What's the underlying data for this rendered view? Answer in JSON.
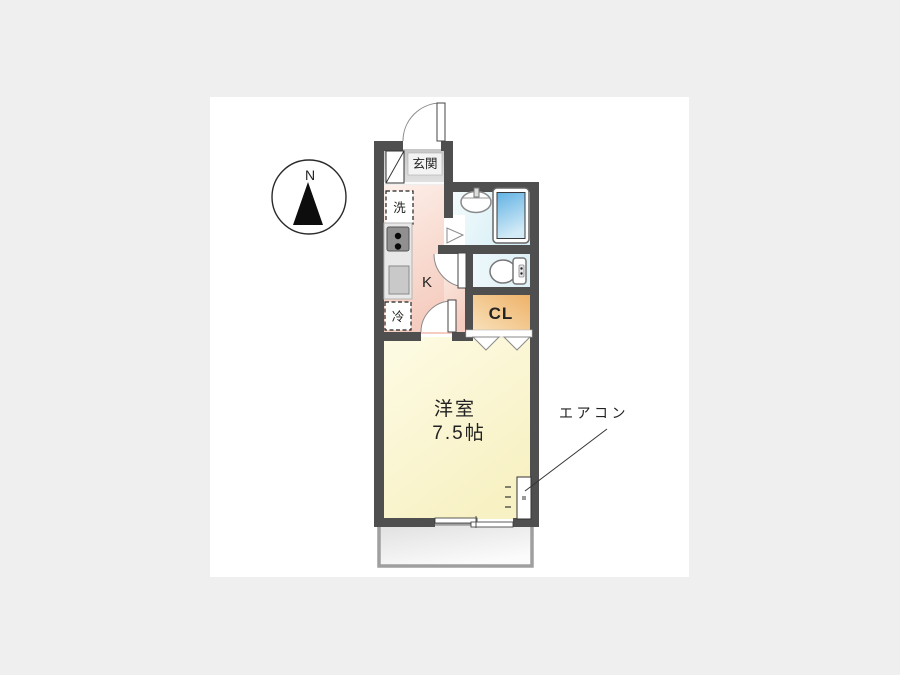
{
  "compass": {
    "north_label": "N"
  },
  "plan": {
    "entrance": {
      "label": "玄関"
    },
    "laundry": {
      "label": "洗"
    },
    "refrigerator": {
      "label": "冷"
    },
    "kitchen": {
      "label": "K"
    },
    "closet": {
      "label": "CL"
    },
    "main_room": {
      "name": "洋室",
      "size": "7.5帖"
    },
    "aircon": {
      "label": "エアコン"
    }
  },
  "colors": {
    "page_background": "#efefef",
    "canvas_background": "#ffffff",
    "wall": "#4f4f4f",
    "entrance_floor_gradient": [
      "#c6c6c6",
      "#e2e2e2"
    ],
    "kitchen_floor_gradient": [
      "#fdf0ea",
      "#f5cdc0"
    ],
    "bathroom_floor_gradient": [
      "#f3fbfc",
      "#d5eef5"
    ],
    "toilet_floor_gradient": [
      "#edf8fb",
      "#ddf0f7"
    ],
    "closet_gradient": [
      "#f9e2bc",
      "#eeb269"
    ],
    "main_room_gradient": [
      "#fdfbe4",
      "#f8f1c4"
    ],
    "bathtub_gradient": [
      "#62b2e4",
      "#d3ebf7"
    ],
    "balcony_gradient": [
      "#e0e0e0",
      "#fbfbfb"
    ],
    "balcony_border": "#9f9f9f"
  }
}
